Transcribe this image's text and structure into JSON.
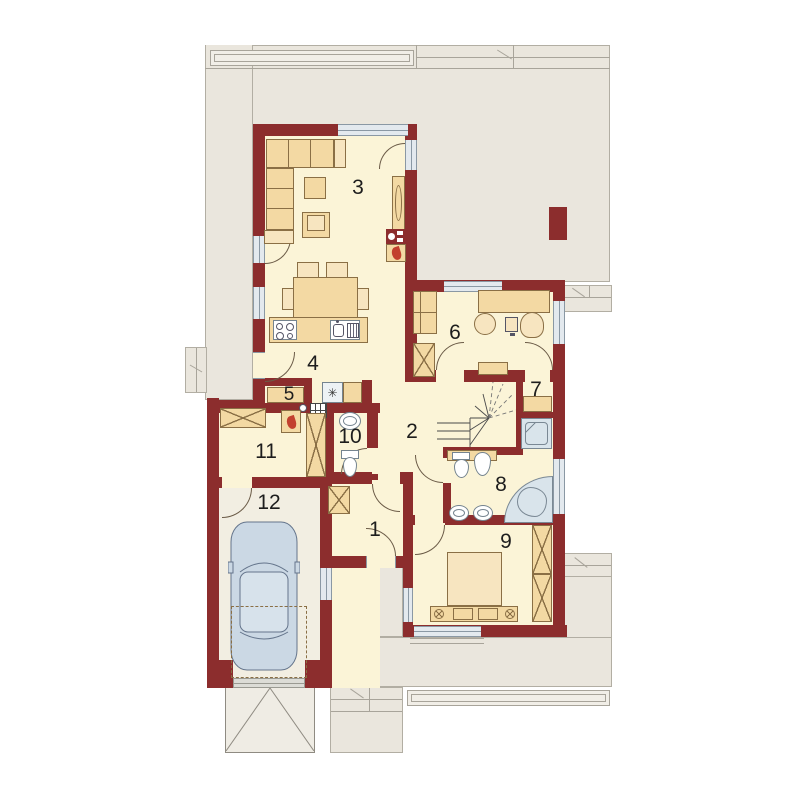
{
  "rooms": [
    {
      "id": "room-1",
      "label": "1"
    },
    {
      "id": "room-2",
      "label": "2"
    },
    {
      "id": "room-3",
      "label": "3"
    },
    {
      "id": "room-4",
      "label": "4"
    },
    {
      "id": "room-5",
      "label": "5"
    },
    {
      "id": "room-6",
      "label": "6"
    },
    {
      "id": "room-7",
      "label": "7"
    },
    {
      "id": "room-8",
      "label": "8"
    },
    {
      "id": "room-9",
      "label": "9"
    },
    {
      "id": "room-10",
      "label": "10"
    },
    {
      "id": "room-11",
      "label": "11"
    },
    {
      "id": "room-12",
      "label": "12"
    }
  ],
  "symbols": {
    "freezer_star": "✳"
  },
  "colors": {
    "wall": "#8C2D2D",
    "floor": "#FBF4D7",
    "garage_floor": "#F2EEE2",
    "terrace": "#EAE6DD",
    "furniture": "#F3D9A3",
    "furniture_light": "#F7E5C0",
    "glass": "#E3E9EE",
    "car": "#CBD8E4",
    "flame": "#C2402E",
    "fixture": "#FFFFFF"
  }
}
